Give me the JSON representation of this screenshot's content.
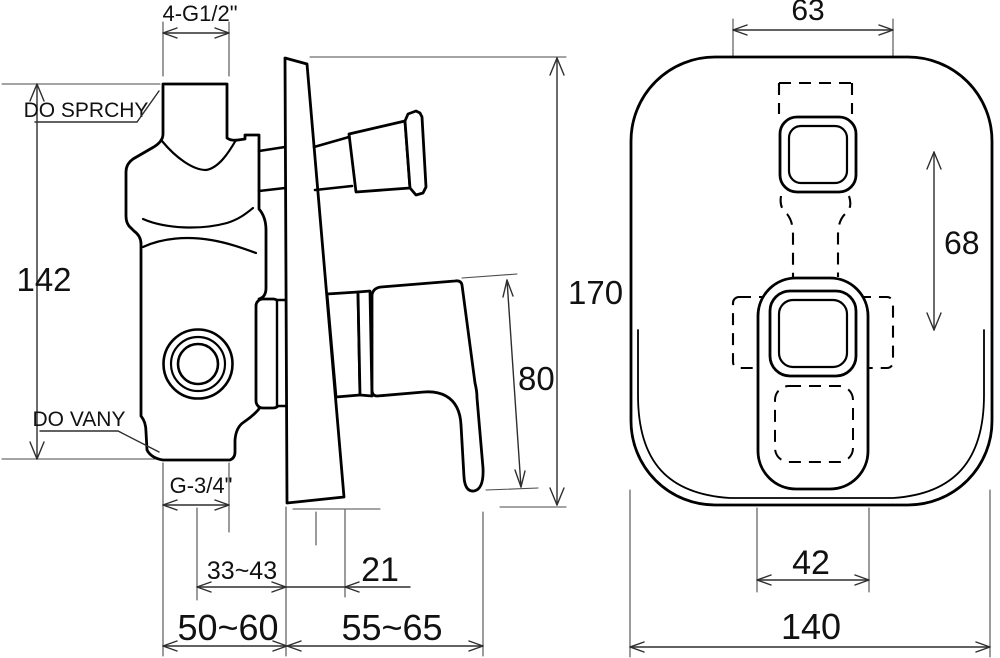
{
  "drawing": {
    "kind": "technical-dimension-drawing",
    "colors": {
      "line": "#000000",
      "dim_line": "#2e2e2e",
      "background": "#ffffff"
    },
    "side_view": {
      "dim_top_thread": "4-G1/2\"",
      "label_to_shower": "DO SPRCHY",
      "label_to_bath": "DO VANY",
      "dim_body_height": "142",
      "dim_overall_height": "170",
      "dim_handle_length": "80",
      "dim_bottom_thread": "G-3/4\"",
      "dim_depth_range": "33~43",
      "dim_plate_thickness": "21",
      "dim_install_depth_left": "50~60",
      "dim_install_depth_right": "55~65"
    },
    "front_view": {
      "dim_valve_body_width": "63",
      "dim_centers_distance": "68",
      "dim_handle_base_width": "42",
      "dim_plate_width": "140"
    }
  }
}
